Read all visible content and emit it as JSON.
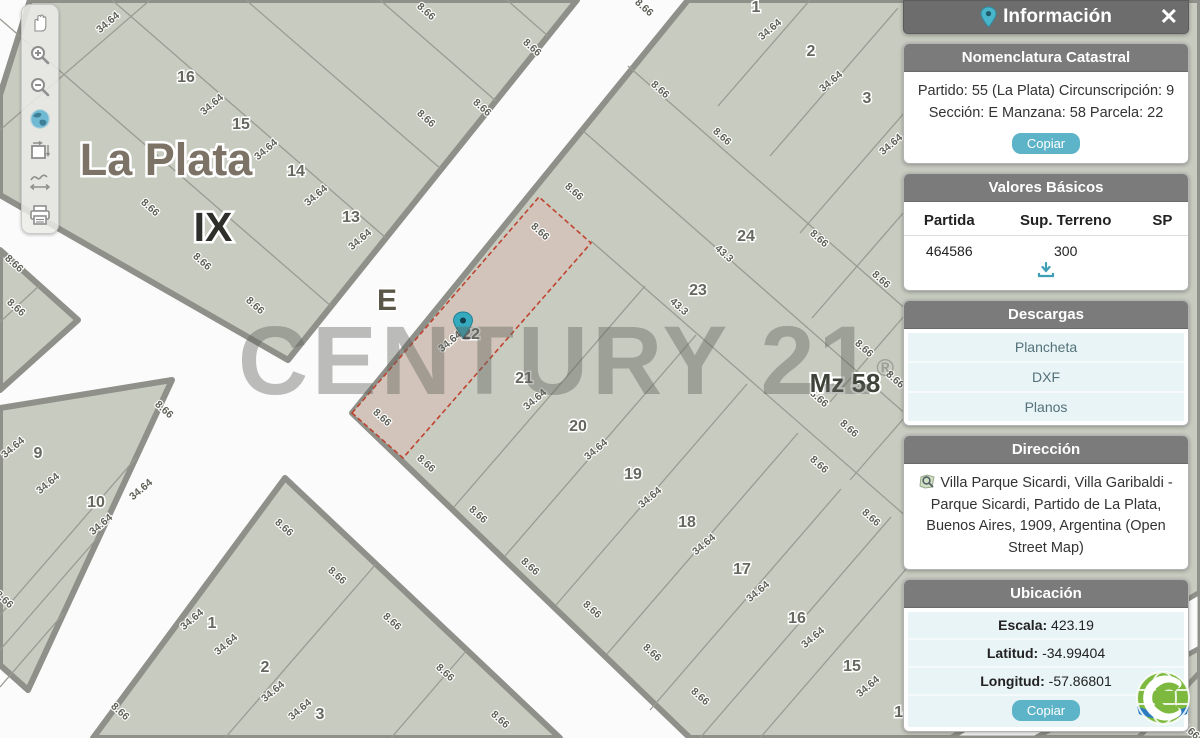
{
  "toolbar": {
    "tools": [
      {
        "name": "pan-hand"
      },
      {
        "name": "zoom-in"
      },
      {
        "name": "zoom-out"
      },
      {
        "name": "globe-extent"
      },
      {
        "name": "select-extent"
      },
      {
        "name": "measure-distance"
      },
      {
        "name": "print"
      }
    ]
  },
  "map": {
    "city_label": "La Plata",
    "circunscripcion_label": "IX",
    "section_label": "E",
    "manzana_label": "Mz 58",
    "selected_parcel_number": "22",
    "parcel_numbers": [
      {
        "n": "16",
        "x": 186,
        "y": 82
      },
      {
        "n": "15",
        "x": 241,
        "y": 129
      },
      {
        "n": "14",
        "x": 296,
        "y": 176
      },
      {
        "n": "13",
        "x": 351,
        "y": 222
      },
      {
        "n": "9",
        "x": 38,
        "y": 458
      },
      {
        "n": "10",
        "x": 96,
        "y": 507
      },
      {
        "n": "1",
        "x": 212,
        "y": 628
      },
      {
        "n": "2",
        "x": 265,
        "y": 672
      },
      {
        "n": "3",
        "x": 320,
        "y": 719
      },
      {
        "n": "1",
        "x": 756,
        "y": 12
      },
      {
        "n": "2",
        "x": 811,
        "y": 56
      },
      {
        "n": "3",
        "x": 867,
        "y": 103
      },
      {
        "n": "24",
        "x": 746,
        "y": 241
      },
      {
        "n": "23",
        "x": 698,
        "y": 295
      },
      {
        "n": "21",
        "x": 524,
        "y": 383
      },
      {
        "n": "20",
        "x": 578,
        "y": 431
      },
      {
        "n": "19",
        "x": 633,
        "y": 479
      },
      {
        "n": "18",
        "x": 687,
        "y": 527
      },
      {
        "n": "17",
        "x": 742,
        "y": 574
      },
      {
        "n": "16",
        "x": 797,
        "y": 623
      },
      {
        "n": "15",
        "x": 852,
        "y": 671
      },
      {
        "n": "14",
        "x": 903,
        "y": 717
      }
    ],
    "dim_labels": [
      {
        "t": "34.64",
        "x": 110,
        "y": 25,
        "r": -40
      },
      {
        "t": "34.64",
        "x": 214,
        "y": 107,
        "r": -40
      },
      {
        "t": "34.64",
        "x": 268,
        "y": 152,
        "r": -40
      },
      {
        "t": "34.64",
        "x": 318,
        "y": 198,
        "r": -40
      },
      {
        "t": "34.64",
        "x": 362,
        "y": 242,
        "r": -40
      },
      {
        "t": "8.66",
        "x": 424,
        "y": 14,
        "r": 42
      },
      {
        "t": "8.66",
        "x": 530,
        "y": 50,
        "r": 42
      },
      {
        "t": "8.66",
        "x": 480,
        "y": 110,
        "r": 42
      },
      {
        "t": "8.66",
        "x": 424,
        "y": 121,
        "r": 42
      },
      {
        "t": "8.66",
        "x": 148,
        "y": 210,
        "r": 42
      },
      {
        "t": "8.66",
        "x": 200,
        "y": 264,
        "r": 42
      },
      {
        "t": "8.66",
        "x": 253,
        "y": 308,
        "r": 42
      },
      {
        "t": "8.66",
        "x": 12,
        "y": 266,
        "r": 42
      },
      {
        "t": "8.66",
        "x": 14,
        "y": 310,
        "r": 42
      },
      {
        "t": "34.64",
        "x": 15,
        "y": 450,
        "r": -40
      },
      {
        "t": "34.64",
        "x": 50,
        "y": 486,
        "r": -40
      },
      {
        "t": "34.64",
        "x": 143,
        "y": 492,
        "r": -40
      },
      {
        "t": "34.64",
        "x": 103,
        "y": 527,
        "r": -40
      },
      {
        "t": "8.66",
        "x": 162,
        "y": 412,
        "r": 42
      },
      {
        "t": "8.66",
        "x": 2,
        "y": 602,
        "r": 42
      },
      {
        "t": "34.64",
        "x": 194,
        "y": 622,
        "r": -40
      },
      {
        "t": "34.64",
        "x": 228,
        "y": 647,
        "r": -40
      },
      {
        "t": "34.64",
        "x": 275,
        "y": 694,
        "r": -40
      },
      {
        "t": "34.64",
        "x": 302,
        "y": 712,
        "r": -40
      },
      {
        "t": "8.66",
        "x": 282,
        "y": 530,
        "r": 42
      },
      {
        "t": "8.66",
        "x": 335,
        "y": 578,
        "r": 42
      },
      {
        "t": "8.66",
        "x": 118,
        "y": 714,
        "r": 42
      },
      {
        "t": "8.66",
        "x": 390,
        "y": 624,
        "r": 42
      },
      {
        "t": "8.66",
        "x": 443,
        "y": 675,
        "r": 42
      },
      {
        "t": "8.66",
        "x": 498,
        "y": 722,
        "r": 42
      },
      {
        "t": "8.66",
        "x": 642,
        "y": 10,
        "r": 42
      },
      {
        "t": "8.66",
        "x": 658,
        "y": 92,
        "r": 42
      },
      {
        "t": "8.66",
        "x": 720,
        "y": 139,
        "r": 42
      },
      {
        "t": "8.66",
        "x": 572,
        "y": 194,
        "r": 42
      },
      {
        "t": "8.66",
        "x": 538,
        "y": 234,
        "r": 42
      },
      {
        "t": "34.64",
        "x": 772,
        "y": 32,
        "r": -40
      },
      {
        "t": "34.64",
        "x": 833,
        "y": 84,
        "r": -40
      },
      {
        "t": "34.64",
        "x": 893,
        "y": 147,
        "r": -40
      },
      {
        "t": "43.3",
        "x": 722,
        "y": 256,
        "r": 42
      },
      {
        "t": "43.3",
        "x": 677,
        "y": 309,
        "r": 42
      },
      {
        "t": "8.66",
        "x": 817,
        "y": 241,
        "r": 42
      },
      {
        "t": "8.66",
        "x": 879,
        "y": 282,
        "r": 42
      },
      {
        "t": "8.66",
        "x": 862,
        "y": 351,
        "r": 42
      },
      {
        "t": "8.66",
        "x": 893,
        "y": 382,
        "r": 42
      },
      {
        "t": "8.66",
        "x": 817,
        "y": 401,
        "r": 42
      },
      {
        "t": "8.66",
        "x": 847,
        "y": 431,
        "r": 42
      },
      {
        "t": "8.66",
        "x": 817,
        "y": 467,
        "r": 42
      },
      {
        "t": "8.66",
        "x": 869,
        "y": 520,
        "r": 42
      },
      {
        "t": "34.64",
        "x": 452,
        "y": 344,
        "r": -40
      },
      {
        "t": "34.64",
        "x": 537,
        "y": 402,
        "r": -40
      },
      {
        "t": "34.64",
        "x": 598,
        "y": 452,
        "r": -40
      },
      {
        "t": "34.64",
        "x": 652,
        "y": 500,
        "r": -40
      },
      {
        "t": "34.64",
        "x": 706,
        "y": 547,
        "r": -40
      },
      {
        "t": "34.64",
        "x": 760,
        "y": 594,
        "r": -40
      },
      {
        "t": "34.64",
        "x": 815,
        "y": 640,
        "r": -40
      },
      {
        "t": "34.64",
        "x": 870,
        "y": 689,
        "r": -40
      },
      {
        "t": "8.66",
        "x": 380,
        "y": 420,
        "r": 42
      },
      {
        "t": "8.66",
        "x": 424,
        "y": 466,
        "r": 42
      },
      {
        "t": "8.66",
        "x": 476,
        "y": 517,
        "r": 42
      },
      {
        "t": "8.66",
        "x": 528,
        "y": 569,
        "r": 42
      },
      {
        "t": "8.66",
        "x": 590,
        "y": 612,
        "r": 42
      },
      {
        "t": "8.66",
        "x": 650,
        "y": 655,
        "r": 42
      },
      {
        "t": "8.66",
        "x": 698,
        "y": 699,
        "r": 42
      },
      {
        "t": "8.66",
        "x": 1188,
        "y": 733,
        "r": 42
      }
    ]
  },
  "watermark": {
    "text": "CENTURY 21",
    "reg": "®"
  },
  "panel": {
    "title": "Información",
    "close_label": "✕",
    "nomenclatura": {
      "header": "Nomenclatura Catastral",
      "line1": "Partido: 55 (La Plata) Circunscripción: 9",
      "line2": "Sección: E Manzana: 58 Parcela: 22",
      "copy_label": "Copiar"
    },
    "valores": {
      "header": "Valores Básicos",
      "columns": [
        "Partida",
        "Sup. Terreno",
        "SP"
      ],
      "row": {
        "partida": "464586",
        "sup_terreno": "300",
        "sp": ""
      }
    },
    "descargas": {
      "header": "Descargas",
      "items": [
        {
          "label": "Plancheta"
        },
        {
          "label": "DXF"
        },
        {
          "label": "Planos"
        }
      ]
    },
    "direccion": {
      "header": "Dirección",
      "text": "Villa Parque Sicardi, Villa Garibaldi - Parque Sicardi, Partido de La Plata, Buenos Aires, 1909, Argentina (Open Street Map)"
    },
    "ubicacion": {
      "header": "Ubicación",
      "rows": [
        {
          "label": "Escala:",
          "value": "423.19"
        },
        {
          "label": "Latitud:",
          "value": "-34.99404"
        },
        {
          "label": "Longitud:",
          "value": "-57.86801"
        }
      ],
      "copy_label": "Copiar"
    }
  },
  "colors": {
    "block_fill": "#c8cbc0",
    "block_stroke": "#8e9089",
    "street": "#fbfbfb",
    "selected_fill": "#d2c4ba",
    "selected_stroke": "#bf4430",
    "accent_teal": "#5db3c8",
    "header_gray": "#6d6d6d"
  }
}
